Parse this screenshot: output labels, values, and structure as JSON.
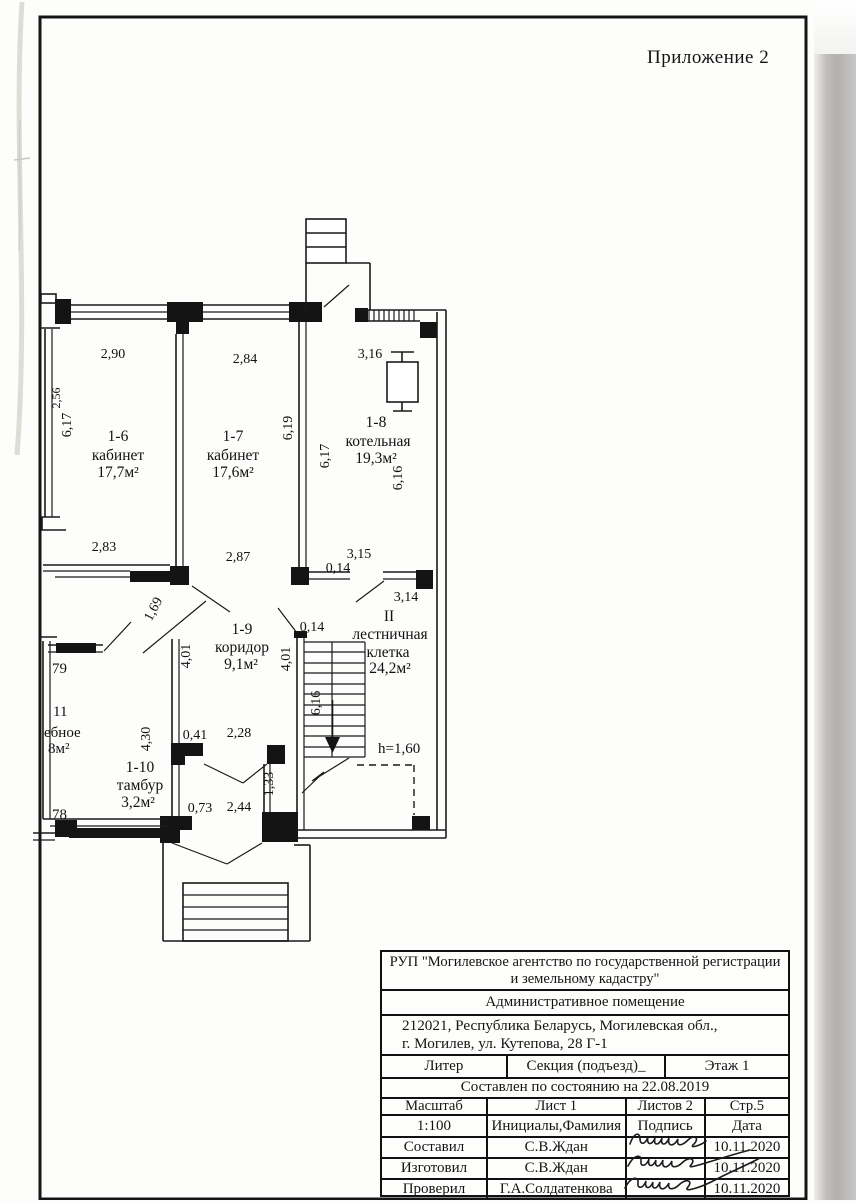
{
  "page": {
    "appendix": "Приложение 2"
  },
  "plan": {
    "rooms": {
      "r16": {
        "num": "1-6",
        "name": "кабинет",
        "area": "17,7м²"
      },
      "r17": {
        "num": "1-7",
        "name": "кабинет",
        "area": "17,6м²"
      },
      "r18": {
        "num": "1-8",
        "name": "котельная",
        "area": "19,3м²"
      },
      "r19": {
        "num": "1-9",
        "name": "коридор",
        "area": "9,1м²"
      },
      "r110": {
        "num": "1-10",
        "name": "тамбур",
        "area": "3,2м²"
      },
      "stairwell": {
        "num": "II",
        "name1": "лестничная",
        "name2": "клетка",
        "area": "24,2м²"
      },
      "r11": {
        "num": "11",
        "name_fragment": "ебное",
        "area_fragment": "8м²",
        "top_fragment": "79",
        "bottom_fragment": "78"
      }
    },
    "dims": {
      "w16_top": "2,90",
      "w17_top": "2,84",
      "w18_top": "3,16",
      "w16_left_part": "2,56",
      "w16_left": "6,17",
      "w17_right": "6,19",
      "w18_left": "6,17",
      "w18_right": "6,16",
      "w16_bottom": "2,83",
      "w17_bottom": "2,87",
      "stair_top_a": "3,15",
      "stair_top_thk": "0,14",
      "stair_top_b": "3,14",
      "stair_wall_thk": "0,14",
      "stair_wall": "4,01",
      "stair_run": "6,16",
      "corr_diag": "1,69",
      "corr_left": "4,01",
      "corr_a": "0,41",
      "corr_b": "2,28",
      "r11_right": "4,30",
      "tamb_a": "0,73",
      "tamb_b": "2,44",
      "stair_door": "1,33",
      "headroom": "h=1,60"
    }
  },
  "title_block": {
    "org_line1": "РУП \"Могилевское агентство по государственной регистрации",
    "org_line2": "и земельному кадастру\"",
    "premise_type": "Административное помещение",
    "address_line1": "212021, Республика Беларусь, Могилевская обл.,",
    "address_line2": "г. Могилев, ул. Кутепова, 28 Г-1",
    "liter_label": "Литер",
    "section_label": "Секция (подъезд)_",
    "floor_label": "Этаж 1",
    "compiled_label": "Составлен по состоянию на  22.08.2019",
    "scale_label": "Масштаб",
    "sheet_label": "Лист 1",
    "sheets_label": "Листов 2",
    "page_label": "Стр.5",
    "scale_value": "1:100",
    "initials_label": "Инициалы,Фамилия",
    "signature_label": "Подпись",
    "date_label": "Дата",
    "rows": [
      {
        "role": "Составил",
        "name": "С.В.Ждан",
        "date": "10.11.2020"
      },
      {
        "role": "Изготовил",
        "name": "С.В.Ждан",
        "date": "10.11.2020"
      },
      {
        "role": "Проверил",
        "name": "Г.А.Солдатенкова",
        "date": "10.11.2020"
      }
    ]
  }
}
